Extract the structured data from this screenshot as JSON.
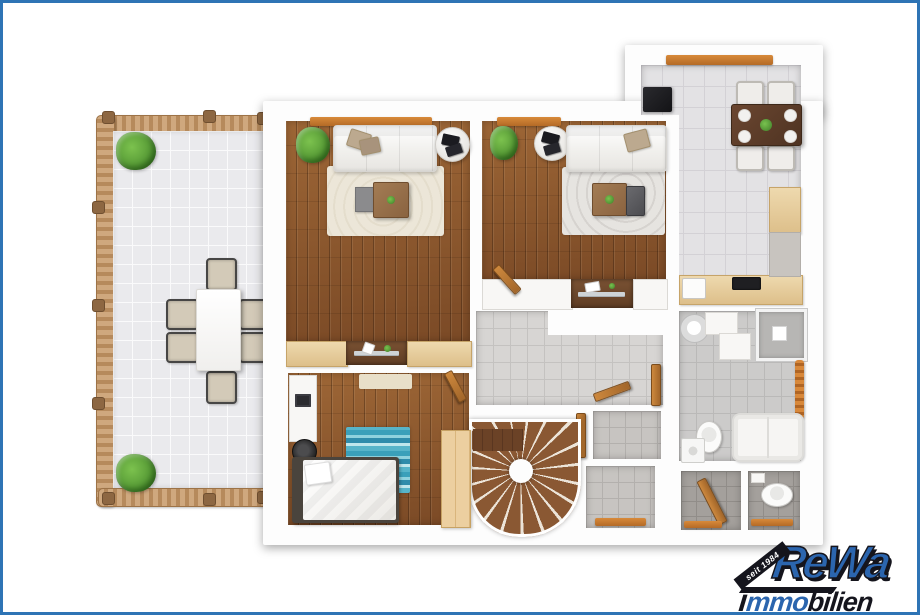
{
  "logo": {
    "badge": "seit 1984",
    "brand": "ReWa",
    "sub_i": "i",
    "sub_blue": "mmo",
    "sub_dark": "bilien"
  },
  "palette": {
    "frame_blue": "#2e74b5",
    "logo_blue": "#2b65ae",
    "logo_ink": "#15151d",
    "wood_base": "#8a5630",
    "terrace_tile": "#eaeaed",
    "kitchen_tile": "#e3e2e4",
    "hall_tile": "#d7d5d3",
    "bath_tile": "#cccbca",
    "dark_tile": "#a4a09c",
    "counter_wood": "#eed9ae",
    "dining_wood": "#4e3322",
    "accent_orange": "#b46a26",
    "rail_wood": "#c29a6e",
    "plant_green": "#4c8f2f",
    "rug_cream": "#e4ddcc",
    "rug_teal": "#57b4c9"
  },
  "floor_plan": {
    "type": "3d-top-down-floor-plan",
    "rooms": [
      {
        "name": "terrace",
        "floor": "light-tile",
        "items": [
          "wood-railing",
          "plant",
          "plant",
          "outdoor-dining-table",
          "six-outdoor-chairs"
        ]
      },
      {
        "name": "living-room-left",
        "floor": "hardwood",
        "items": [
          "window-sill",
          "plant",
          "sofa",
          "throw-pillows",
          "round-side-table",
          "magazines",
          "cream-rug",
          "coffee-table",
          "gray-side-table",
          "sideboards",
          "glass-console-niche"
        ]
      },
      {
        "name": "living-room-right",
        "floor": "hardwood",
        "items": [
          "window-sill",
          "plant",
          "round-side-table",
          "magazines",
          "sofa",
          "throw-pillow",
          "gray-rug",
          "coffee-table",
          "dark-chair",
          "counters",
          "glass-desk-niche",
          "open-door"
        ]
      },
      {
        "name": "kitchen-dining",
        "floor": "light-tile",
        "items": [
          "window-sill",
          "refrigerator",
          "dining-table",
          "four-chairs",
          "plates",
          "centerpiece-plant",
          "l-shaped-counter",
          "cooktop",
          "sink",
          "tall-cabinet"
        ]
      },
      {
        "name": "bedroom",
        "floor": "hardwood",
        "items": [
          "desk",
          "laptop",
          "stool",
          "single-bed",
          "pillow",
          "teal-rug",
          "beige-rug",
          "wardrobe",
          "open-door"
        ]
      },
      {
        "name": "hallway",
        "floor": "gray-tile",
        "items": [
          "spiral-staircase",
          "stair-landing",
          "open-doors",
          "storage-niches",
          "thresholds"
        ]
      },
      {
        "name": "bathroom",
        "floor": "gray-tile",
        "items": [
          "round-washbasin",
          "vanity",
          "shower",
          "towel-radiator",
          "toilet",
          "bathtub",
          "washing-machine"
        ]
      },
      {
        "name": "storage-room",
        "floor": "dark-tile",
        "items": [
          "open-door",
          "threshold"
        ]
      },
      {
        "name": "wc",
        "floor": "dark-tile",
        "items": [
          "cistern",
          "toilet",
          "threshold"
        ]
      }
    ]
  }
}
